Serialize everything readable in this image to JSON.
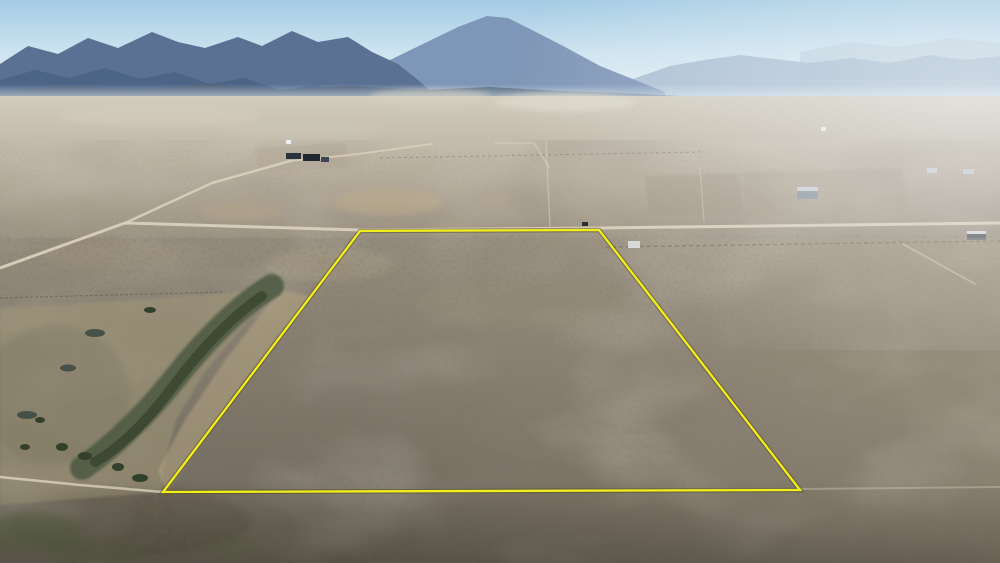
{
  "scene": {
    "description": "Aerial drone photograph of a high-desert sagebrush valley with distant mountain ranges; a rectangular land parcel is outlined in yellow in the center, bounded on top by a dirt road, with scattered rural buildings and a green creek wash at lower left",
    "type": "aerial-photograph"
  },
  "colors": {
    "sky_top": "#a3cbe4",
    "sky_mid": "#cfe4f0",
    "sky_horizon": "#eaf3f9",
    "haze": "#dfeaf2",
    "valley_top": "#d2cdbf",
    "valley_mid": "#bcb2a2",
    "valley_bottom": "#9a9080",
    "ground_top": "#958c7d",
    "ground_mid": "#837b6d",
    "ground_bottom": "#6b6458",
    "road": "#d9d0bc",
    "boundary_yellow": "#f2ee1c",
    "boundary_shadow": "rgba(70,64,20,0.45)"
  },
  "mountains": {
    "far_right": {
      "points": "800,52 850,42 900,47 950,38 1000,43 1000,80 800,80",
      "fill": "#bccedd"
    },
    "right": {
      "points": "630,80 670,66 705,60 740,55 775,59 810,63 850,58 890,63 930,55 965,60 1000,56 1000,112 630,112",
      "fill": "#a2b7cc"
    },
    "peak": {
      "points": "345,84 390,60 425,43 458,27 487,16 508,18 532,30 565,47 600,66 640,82 665,92 665,112 345,112",
      "fill": "#7e96b7"
    },
    "left": {
      "points": "0,64 28,46 58,54 88,38 118,48 152,32 178,42 205,48 238,37 262,46 292,31 318,42 348,37 372,52 398,64 418,80 435,95 435,112 0,112",
      "fill": "#5b7194"
    },
    "left_front": {
      "points": "0,80 35,70 70,78 105,68 140,79 175,72 210,84 245,78 280,90 315,85 350,95 380,102 380,112 0,112",
      "fill": "#4c6385"
    },
    "foothills": {
      "points": "0,92 70,86 140,90 210,84 280,90 350,86 420,90 490,87 560,91 620,93 680,96 740,99 780,101 780,112 0,112",
      "fill": "#4e6077"
    }
  },
  "playa": [
    {
      "cx": 565,
      "cy": 102,
      "rx": 70,
      "ry": 9,
      "fill": "#dcd8ca",
      "opacity": 0.8
    },
    {
      "cx": 430,
      "cy": 96,
      "rx": 60,
      "ry": 7,
      "fill": "#d6d2c4",
      "opacity": 0.6
    },
    {
      "cx": 160,
      "cy": 116,
      "rx": 100,
      "ry": 11,
      "fill": "#d3cec0",
      "opacity": 0.5
    },
    {
      "cx": 300,
      "cy": 130,
      "rx": 80,
      "ry": 10,
      "fill": "#cdc7b8",
      "opacity": 0.4
    }
  ],
  "pads": [
    {
      "points": "742,173 902,168 908,216 748,221",
      "fill": "#a59a88",
      "opacity": 0.55
    },
    {
      "points": "645,176 740,173 743,213 650,216",
      "fill": "#9c9280",
      "opacity": 0.4
    },
    {
      "points": "255,148 345,143 350,168 258,172",
      "fill": "#b0a694",
      "opacity": 0.4
    }
  ],
  "patches": [
    {
      "cx": 388,
      "cy": 202,
      "rx": 55,
      "ry": 13,
      "fill": "#b8a98e",
      "opacity": 0.75
    },
    {
      "cx": 497,
      "cy": 197,
      "rx": 16,
      "ry": 6,
      "fill": "#b5a78c",
      "opacity": 0.6
    },
    {
      "cx": 330,
      "cy": 265,
      "rx": 65,
      "ry": 16,
      "fill": "#a3987f",
      "opacity": 0.45
    },
    {
      "cx": 520,
      "cy": 305,
      "rx": 110,
      "ry": 26,
      "fill": "#8f8674",
      "opacity": 0.35
    },
    {
      "cx": 610,
      "cy": 425,
      "rx": 150,
      "ry": 40,
      "fill": "#80786a",
      "opacity": 0.3
    },
    {
      "cx": 895,
      "cy": 335,
      "rx": 85,
      "ry": 40,
      "fill": "#8e8576",
      "opacity": 0.3
    },
    {
      "cx": 240,
      "cy": 212,
      "rx": 40,
      "ry": 9,
      "fill": "#b3a489",
      "opacity": 0.5
    },
    {
      "cx": 110,
      "cy": 255,
      "rx": 70,
      "ry": 14,
      "fill": "#a0937c",
      "opacity": 0.4
    },
    {
      "cx": 130,
      "cy": 522,
      "rx": 120,
      "ry": 35,
      "fill": "#4b463c",
      "opacity": 0.3
    }
  ],
  "vegetation": {
    "meadow": {
      "points": "0,308 140,300 240,292 272,286 240,330 205,372 176,420 163,470 163,492 90,498 0,505",
      "fill": "#a39878",
      "opacity": 0.5
    },
    "tan_wash": {
      "points": "280,290 310,296 245,380 195,452 166,492 158,470 185,420 225,360",
      "fill": "#b7a883",
      "opacity": 0.5
    },
    "shrub_haze": {
      "cx": 55,
      "cy": 395,
      "rx": 75,
      "ry": 70,
      "fill": "#74725d",
      "opacity": 0.3
    },
    "band_outer": {
      "d": "M272,286 C240,305 205,340 172,382 C148,412 112,448 82,468",
      "stroke": "#47543c"
    },
    "band_inner": {
      "d": "M262,296 C230,318 200,350 170,390 C150,418 120,448 95,462",
      "stroke": "#39462f"
    },
    "tree_fill": "#33402b",
    "trees": [
      {
        "cx": 62,
        "cy": 447,
        "rx": 6,
        "ry": 4
      },
      {
        "cx": 85,
        "cy": 456,
        "rx": 7,
        "ry": 4
      },
      {
        "cx": 118,
        "cy": 467,
        "rx": 6,
        "ry": 4
      },
      {
        "cx": 140,
        "cy": 478,
        "rx": 8,
        "ry": 4
      },
      {
        "cx": 40,
        "cy": 420,
        "rx": 5,
        "ry": 3
      },
      {
        "cx": 25,
        "cy": 447,
        "rx": 5,
        "ry": 3
      },
      {
        "cx": 150,
        "cy": 310,
        "rx": 6,
        "ry": 3
      }
    ],
    "pond_fill": "#3e4b44",
    "ponds": [
      {
        "cx": 95,
        "cy": 333,
        "rx": 10,
        "ry": 4
      },
      {
        "cx": 68,
        "cy": 368,
        "rx": 8,
        "ry": 3.5
      },
      {
        "cx": 27,
        "cy": 415,
        "rx": 10,
        "ry": 4
      }
    ],
    "green_patches": [
      {
        "cx": 35,
        "cy": 532,
        "rx": 46,
        "ry": 20,
        "fill": "#5a6845",
        "opacity": 0.5
      },
      {
        "cx": 95,
        "cy": 554,
        "rx": 50,
        "ry": 14,
        "fill": "#5a6845",
        "opacity": 0.4
      },
      {
        "cx": 232,
        "cy": 548,
        "rx": 26,
        "ry": 10,
        "fill": "#5f6b47",
        "opacity": 0.45
      }
    ]
  },
  "roads": {
    "main": {
      "points": "0,268 125,223 360,230 599,228 1000,223"
    },
    "branch": {
      "points": "125,223 212,183 290,161"
    },
    "branch2": {
      "points": "290,161 350,155 432,144"
    },
    "section_v1": {
      "points": "546,141 550,226"
    },
    "section_v2": {
      "points": "700,167 704,222"
    },
    "mid_l": {
      "points": "495,143 534,143 549,167"
    },
    "trail": {
      "points": "0,477 80,485 163,492"
    },
    "trail2": {
      "points": "163,492 800,489 1000,487"
    },
    "driveway": {
      "points": "903,244 975,284"
    }
  },
  "fences": [
    {
      "points": "605,247 1000,241",
      "stroke": "#5a5345",
      "opacity": 0.55
    },
    {
      "points": "380,158 700,152",
      "stroke": "#6b6354",
      "opacity": 0.4
    },
    {
      "points": "0,298 225,292",
      "stroke": "#565a48",
      "opacity": 0.5
    }
  ],
  "buildings": [
    {
      "x": 286,
      "y": 153,
      "w": 15,
      "h": 6,
      "fill": "#2b333f"
    },
    {
      "x": 303,
      "y": 154,
      "w": 17,
      "h": 7,
      "fill": "#202731"
    },
    {
      "x": 321,
      "y": 157,
      "w": 8,
      "h": 5,
      "fill": "#3b4450"
    },
    {
      "x": 286,
      "y": 140,
      "w": 5,
      "h": 4,
      "fill": "#edf0f2"
    },
    {
      "x": 797,
      "y": 187,
      "w": 21,
      "h": 12,
      "fill": "#8f98a1"
    },
    {
      "x": 797,
      "y": 187,
      "w": 21,
      "h": 4,
      "fill": "#c9ced3"
    },
    {
      "x": 927,
      "y": 168,
      "w": 10,
      "h": 5,
      "fill": "#c6cacf"
    },
    {
      "x": 963,
      "y": 169,
      "w": 11,
      "h": 5,
      "fill": "#c1c6cb"
    },
    {
      "x": 967,
      "y": 231,
      "w": 19,
      "h": 9,
      "fill": "#595f66"
    },
    {
      "x": 967,
      "y": 231,
      "w": 19,
      "h": 3,
      "fill": "#d4d7d9"
    },
    {
      "x": 628,
      "y": 241,
      "w": 12,
      "h": 7,
      "fill": "#d7dadc"
    },
    {
      "x": 582,
      "y": 222,
      "w": 6,
      "h": 4,
      "fill": "#24282c"
    },
    {
      "x": 821,
      "y": 127,
      "w": 5,
      "h": 4,
      "fill": "#e5e9eb"
    }
  ],
  "parcel": {
    "points": "360,231 599,230 800,490 163,492",
    "stroke_width": 2.3
  }
}
